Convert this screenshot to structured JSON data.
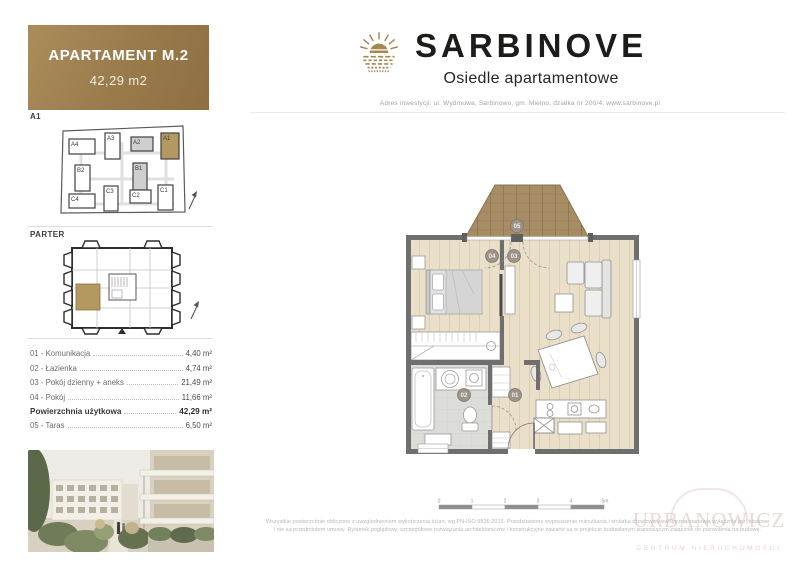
{
  "card": {
    "title": "APARTAMENT M.2",
    "area": "42,29 m2"
  },
  "brand": {
    "name": "SARBINOVE",
    "subtitle": "Osiedle apartamentowe",
    "address": "Adres inwestycji: ul. Wydmowa, Sarbinowo, gm. Mielno, działka nr 200/4; www.sarbinove.pl"
  },
  "site_plan": {
    "label": "A1",
    "buildings": [
      "A4",
      "A3",
      "A2",
      "A1",
      "B2",
      "B1",
      "C4",
      "C3",
      "C2",
      "C1"
    ],
    "highlighted_building": "A1"
  },
  "floor_overview": {
    "label": "PARTER"
  },
  "room_list": {
    "rows": [
      {
        "label": "01 - Komunikacja",
        "value": "4,40 m²"
      },
      {
        "label": "02 - Łazienka",
        "value": "4,74 m²"
      },
      {
        "label": "03 - Pokój dzienny + aneks",
        "value": "21,49 m²"
      },
      {
        "label": "04 - Pokój",
        "value": "11,66 m²"
      },
      {
        "label": "Powierzchnia użytkowa",
        "value": "42,29 m²"
      },
      {
        "label": "05 - Taras",
        "value": "6,50 m²"
      }
    ]
  },
  "floor_plan": {
    "badges": {
      "communication": "01",
      "bathroom": "02",
      "living_room": "03",
      "bedroom": "04",
      "terrace": "05"
    }
  },
  "scale_bar": {
    "labels": [
      "0",
      "1",
      "2",
      "3",
      "4",
      "5m"
    ]
  },
  "disclaimer": {
    "line1": "Wszystkie powierzchnie obliczono z uwzględnieniem wykończenia ścian, wg PN-ISO 9836:2015. Przedstawione wyposażenie mieszkania i stolarka drzwiowa wewnętrzna stanowią wyłącznie przykładowe",
    "line2": "i nie są przedmiotem umowy. Rysunek poglądowy, szczegółowe rozwiązania architektoniczne i konstrukcyjne zawarte są w projekcie budowlanym stanowiącym załącznik do pozwolenia na budowę."
  },
  "watermark": {
    "line1": "URBANOWICZ",
    "line2": "CENTRUM NIERUCHOMOŚCI"
  },
  "colors": {
    "gold": "#a5884f",
    "wall": "#6f6f6f",
    "wood_floor": "#eadfc9",
    "terrace_wood": "#a78d66",
    "bath_floor": "#dcdcd8",
    "watermark": "#cd9696"
  }
}
